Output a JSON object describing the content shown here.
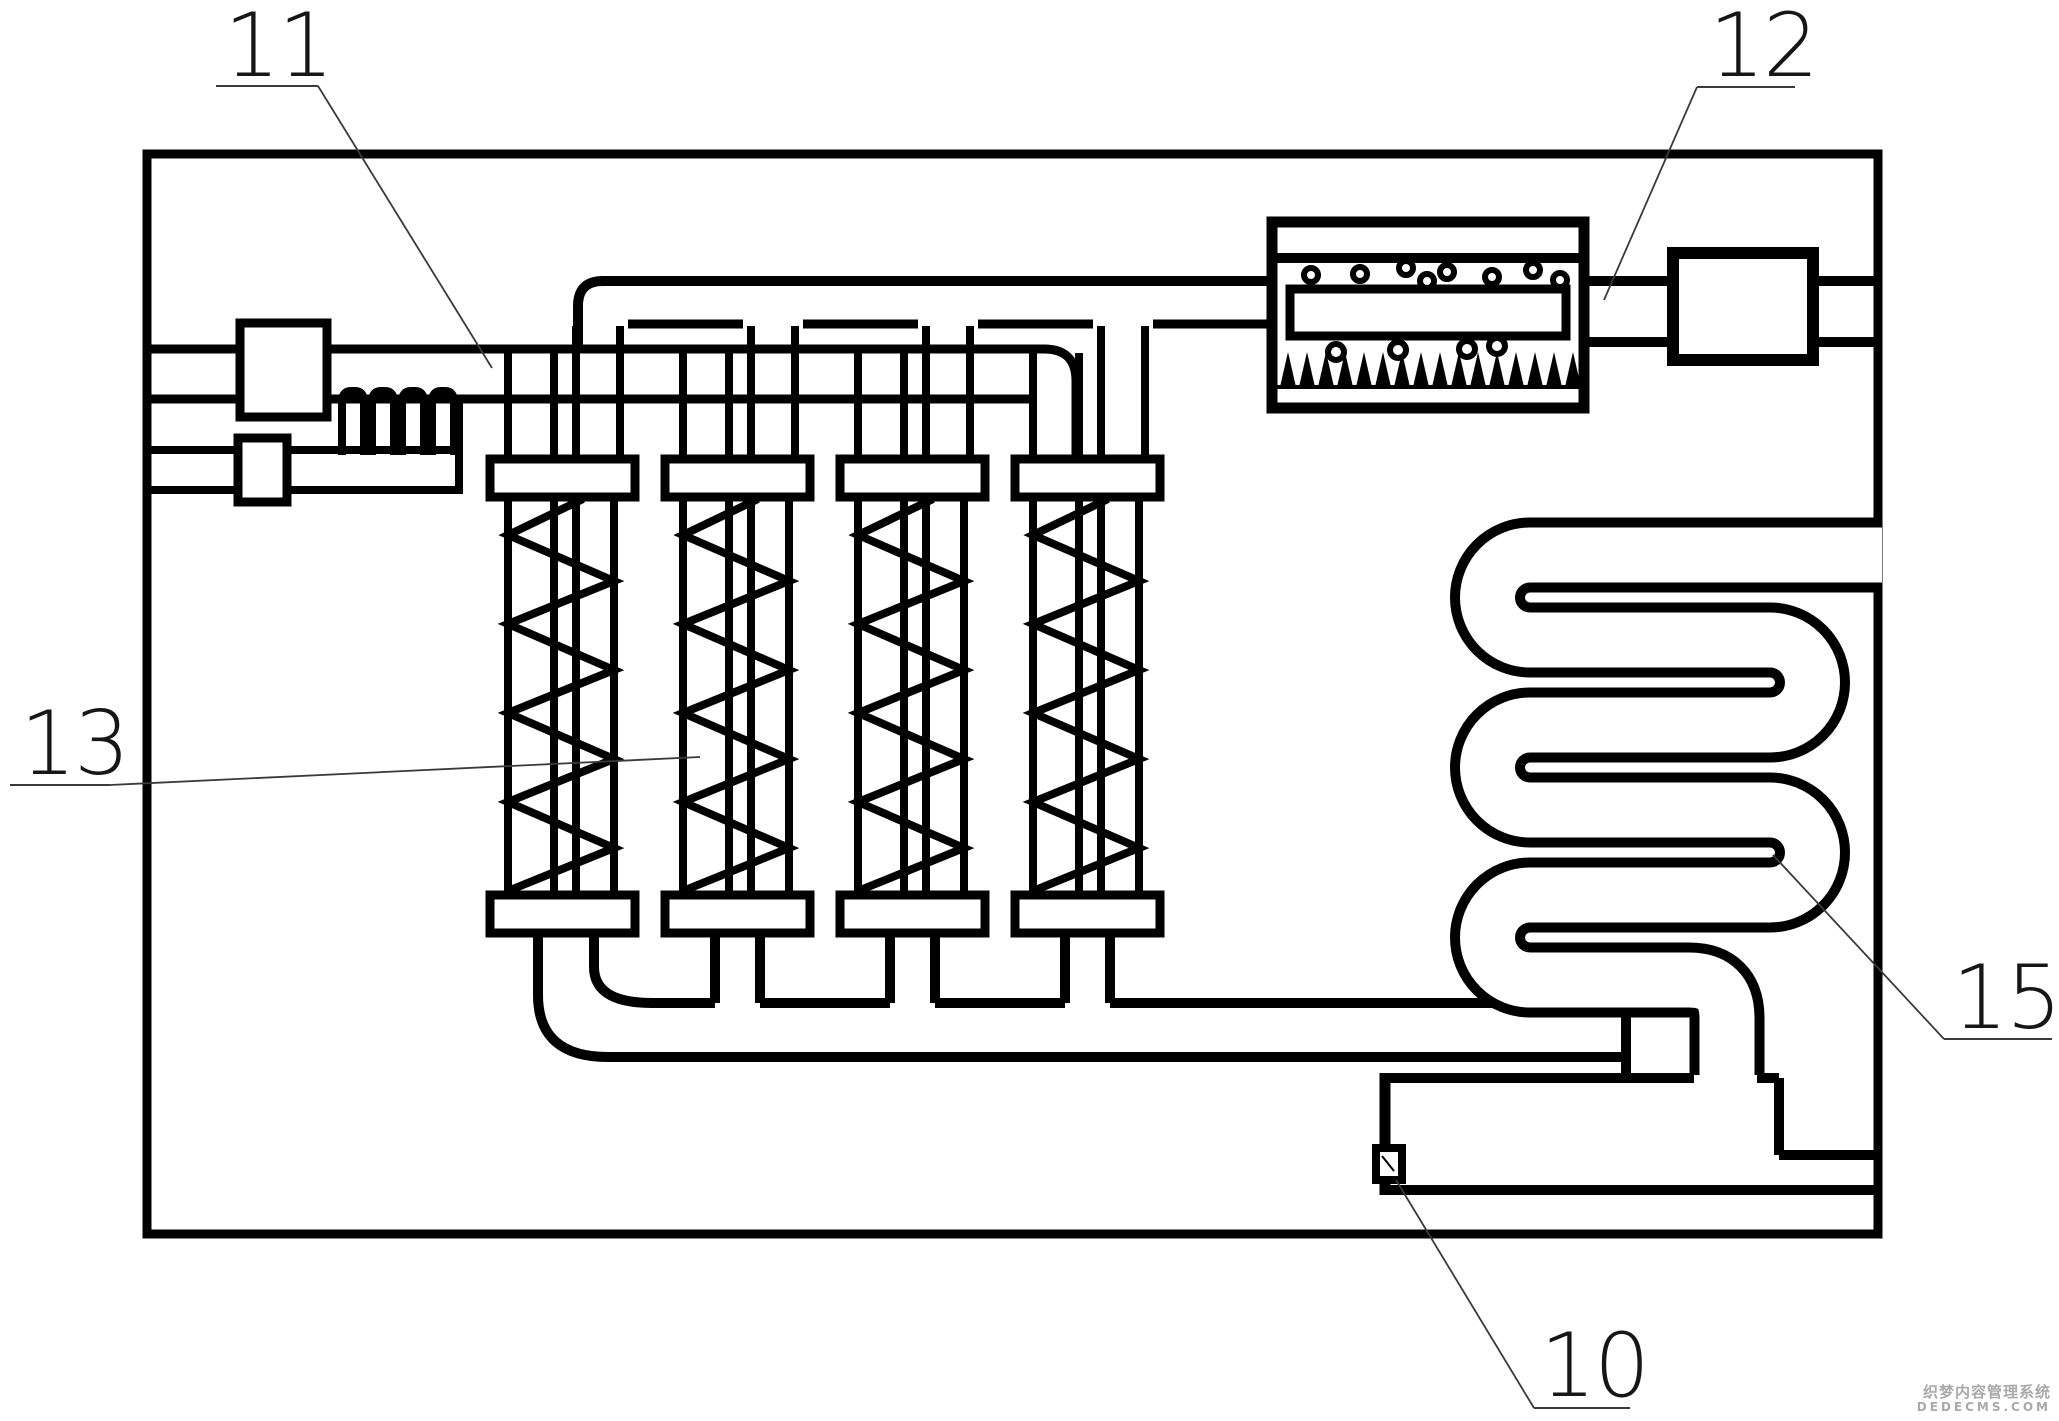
{
  "figure": {
    "type": "patent-technical-diagram",
    "description": "process system schematic with filter columns, bubble separator, compressor and serpentine coil"
  },
  "annotations": {
    "labels": [
      {
        "id": "11",
        "text": "11",
        "target": "upper-feed-pipe"
      },
      {
        "id": "12",
        "text": "12",
        "target": "bubble-separator-outlet"
      },
      {
        "id": "13",
        "text": "13",
        "target": "filter-column"
      },
      {
        "id": "15",
        "text": "15",
        "target": "serpentine-coil"
      },
      {
        "id": "10",
        "text": "10",
        "target": "sensor-box"
      }
    ]
  },
  "watermark": {
    "line1": "织梦内容管理系统",
    "line2": "DEDECMS.COM"
  },
  "filter_columns": {
    "count": 4,
    "xs": [
      490,
      665,
      840,
      1015
    ]
  },
  "bubble_separator": {
    "teeth_count": 16,
    "upper_bubbles": [
      [
        1311,
        275
      ],
      [
        1360,
        274
      ],
      [
        1406,
        268
      ],
      [
        1427,
        281
      ],
      [
        1447,
        272
      ],
      [
        1492,
        277
      ],
      [
        1533,
        270
      ],
      [
        1560,
        280
      ]
    ],
    "lower_bubbles": [
      [
        1336,
        352
      ],
      [
        1398,
        350
      ],
      [
        1467,
        349
      ],
      [
        1497,
        346
      ]
    ]
  },
  "colors": {
    "line": "#000000",
    "label": "#161616",
    "leader": "#3a3a3a",
    "watermark": "#a9a9a9",
    "background": "#ffffff"
  }
}
